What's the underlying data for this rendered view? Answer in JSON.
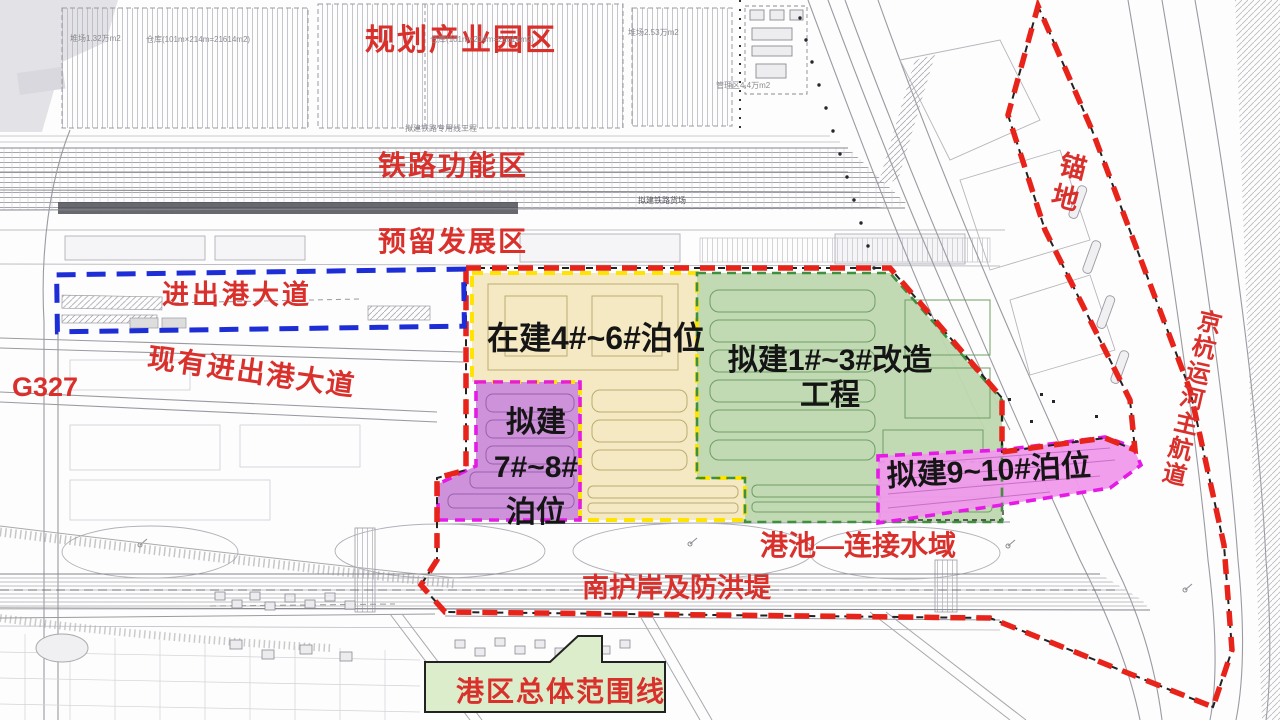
{
  "labels": {
    "planning_park": "规划产业园区",
    "railway_zone": "铁路功能区",
    "reserved_zone": "预留发展区",
    "port_avenue": "进出港大道",
    "existing_avenue": "现有进出港大道",
    "g327": "G327",
    "anchorage": "锚地",
    "canal": "京杭运河主航道",
    "basin": "港池—连接水域",
    "revetment": "南护岸及防洪堤",
    "boundary": "港区总体范围线"
  },
  "zones": {
    "berths_4_6": {
      "label": "在建4#~6#泊位"
    },
    "berths_1_3": {
      "line1": "拟建1#~3#改造",
      "line2": "工程"
    },
    "berths_7_8": {
      "line1": "拟建",
      "line2": "7#~8#",
      "line3": "泊位"
    },
    "berths_9_10": {
      "label": "拟建9~10#泊位"
    }
  },
  "annotations": {
    "yard_small": "堆场1.32万m2",
    "warehouse_a": "仓库(101m×214m=21614m2)",
    "warehouse_b": "仓库(101m×214m=21614m2)",
    "yard_large": "堆场2.53万m2",
    "admin_area": "管理区4.4万m2",
    "rail_spur": "拟建铁路专用线工程",
    "rail_yard": "拟建铁路货场"
  },
  "colors": {
    "red_label": "#d9302c",
    "black_label": "#151515",
    "boundary_red": "#e8231a",
    "boundary_blue": "#1e2ed6",
    "zone_yellow": "#f3e8c0",
    "zone_green": "#bed8b0",
    "zone_purple": "#ca8cd8",
    "zone_pink": "#f09aec",
    "dash_yellow": "#ffe400",
    "dash_magenta": "#e61ae6",
    "dash_green": "#3f8f3f",
    "callout_fill": "#dcedcb"
  }
}
